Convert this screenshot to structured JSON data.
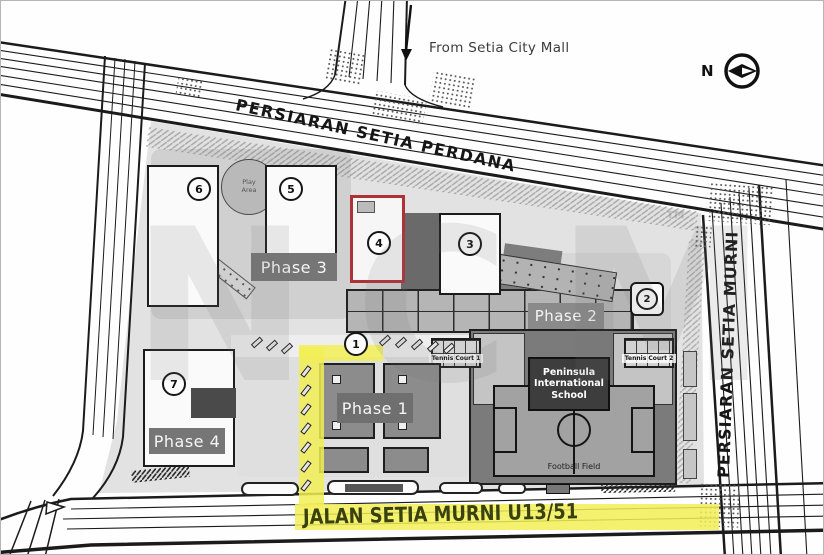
{
  "roads": {
    "perdana": "PERSIARAN SETIA PERDANA",
    "murni": "PERSIARAN SETIA MURNI",
    "jalan": "JALAN SETIA MURNI U13/51"
  },
  "annotations": {
    "from_mall": "From Setia City Mall",
    "compass": "N",
    "watermark": "NCM",
    "watermark_tm": "™"
  },
  "phases": {
    "p1": "Phase 1",
    "p2": "Phase 2",
    "p3": "Phase 3",
    "p4": "Phase 4"
  },
  "markers": [
    "1",
    "2",
    "3",
    "4",
    "5",
    "6",
    "7"
  ],
  "amenities": {
    "play_area": "Play Area",
    "school_name": "Peninsula International School",
    "football_field": "Football Field",
    "tennis_court_1": "Tennis Court 1",
    "tennis_court_2": "Tennis Court 2"
  },
  "colors": {
    "highlight_yellow": "#f2ef56",
    "selected_unit_red": "#b03038",
    "site_gray": "#e2e2e2"
  }
}
